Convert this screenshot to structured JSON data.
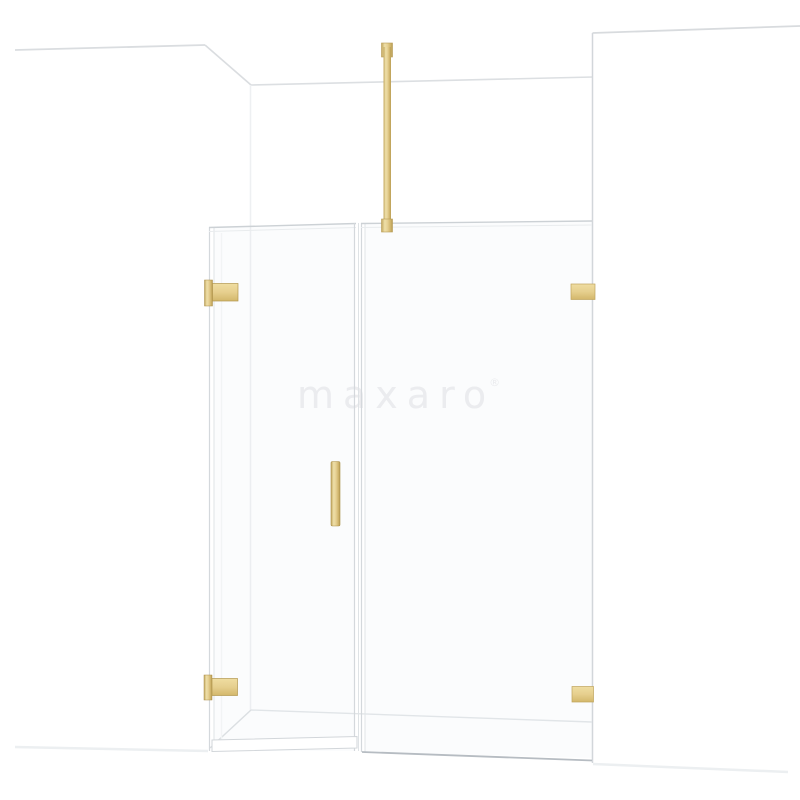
{
  "product_image": {
    "description": "front view render of a hinged shower door with fixed side panel, gold hardware, in a white room corner",
    "background_color": "#ffffff",
    "watermark": {
      "text": "maxaro",
      "registered_mark": "®",
      "color": "#ededef"
    },
    "hardware_finish": "gold",
    "colors": {
      "gold_light": "#f0e1ab",
      "gold_mid": "#e3cc8c",
      "gold_dark": "#bfa45c",
      "gold_edge": "#a98d48",
      "glass_edge_line": "#d4d8dc",
      "wall_line": "#d8dbde",
      "floor_line_dark": "#b6bcc2",
      "floor_line_soft": "#eceff1"
    },
    "parts": [
      "left-wall",
      "back-wall",
      "right-wall",
      "hinged-door-glass",
      "fixed-panel-glass",
      "ceiling-support-bar",
      "door-handle",
      "wall-hinge-top",
      "wall-hinge-bottom",
      "panel-wall-bracket-top",
      "panel-wall-bracket-bottom"
    ]
  }
}
